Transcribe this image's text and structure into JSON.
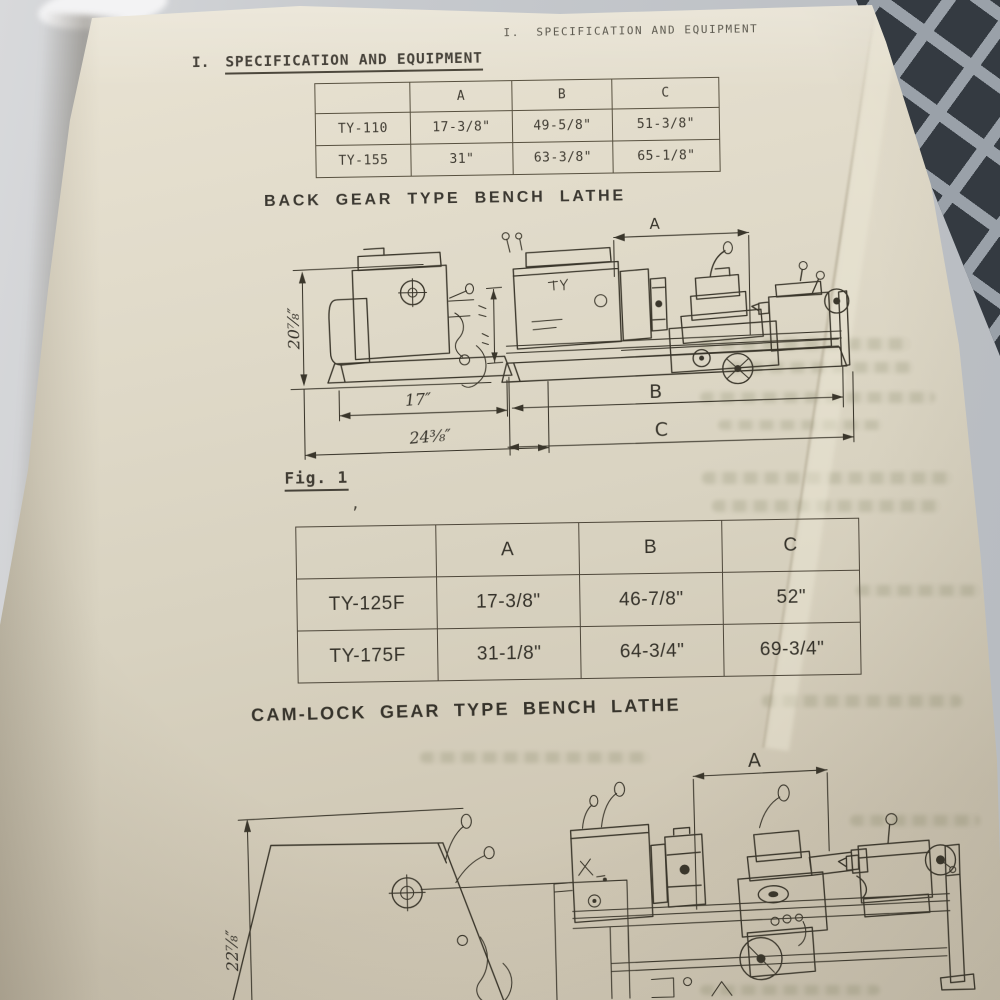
{
  "header_right": "I.  SPECIFICATION AND EQUIPMENT",
  "section_heading": {
    "index": "I.",
    "title": "SPECIFICATION AND EQUIPMENT"
  },
  "spec_table_back_gear": {
    "col_headers": [
      "A",
      "B",
      "C"
    ],
    "rows": [
      {
        "model": "TY-110",
        "A": "17-3/8\"",
        "B": "49-5/8\"",
        "C": "51-3/8\""
      },
      {
        "model": "TY-155",
        "A": "31\"",
        "B": "63-3/8\"",
        "C": "65-1/8\""
      }
    ]
  },
  "back_gear": {
    "title": "BACK GEAR TYPE BENCH LATHE",
    "caption": "Fig. 1",
    "stray_mark": ",",
    "dim_a": "A",
    "dim_b": "B",
    "dim_c": "C",
    "dim_width": "17″",
    "dim_base": "24⅜″",
    "dim_height": "20⅞″"
  },
  "spec_table_cam_lock": {
    "col_headers": [
      "A",
      "B",
      "C"
    ],
    "rows": [
      {
        "model": "TY-125F",
        "A": "17-3/8\"",
        "B": "46-7/8\"",
        "C": "52\""
      },
      {
        "model": "TY-175F",
        "A": "31-1/8\"",
        "B": "64-3/4\"",
        "C": "69-3/4\""
      }
    ]
  },
  "cam_lock": {
    "title": "CAM-LOCK GEAR TYPE BENCH LATHE",
    "dim_a": "A",
    "dim_height": "22⅞″"
  }
}
